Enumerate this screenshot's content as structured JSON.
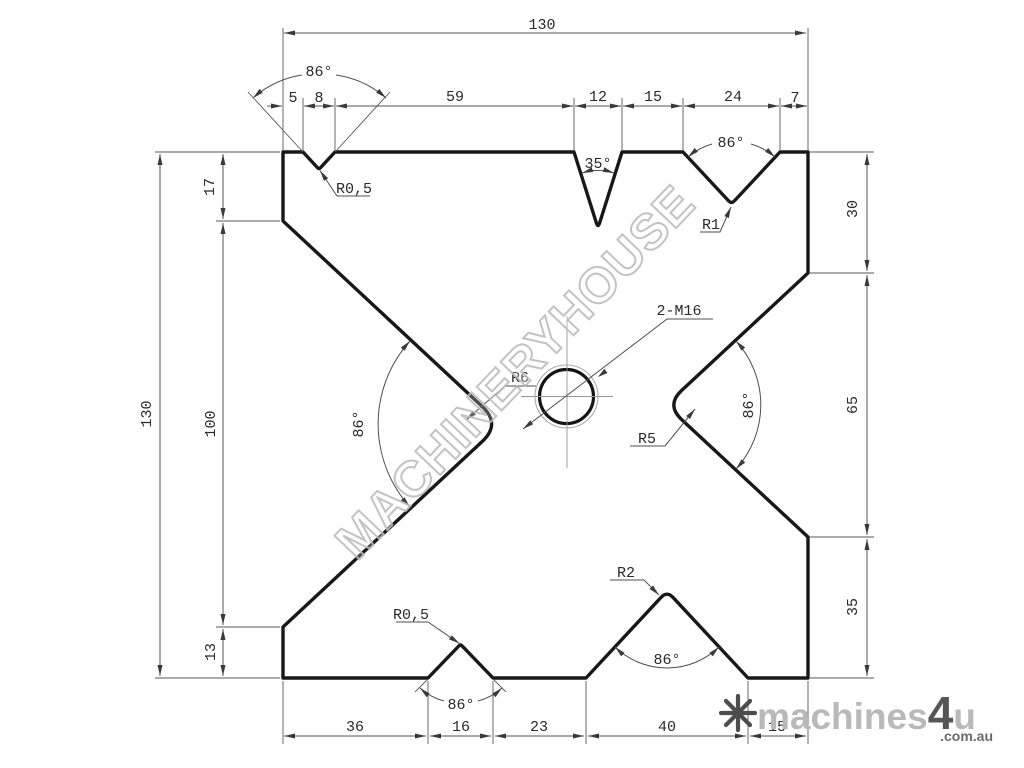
{
  "drawing": {
    "description": "press brake 4-way die block engineering drawing",
    "hole_callout": "2-M16"
  },
  "dimensions": {
    "top_overall": "130",
    "top_row": [
      "5",
      "8",
      "59",
      "12",
      "15",
      "24",
      "7"
    ],
    "left_overall": "130",
    "left_segments": [
      "17",
      "100",
      "13"
    ],
    "right_segments": [
      "30",
      "65",
      "35"
    ],
    "bottom_row": [
      "36",
      "16",
      "23",
      "40",
      "15"
    ]
  },
  "angles": {
    "top_left": "86°",
    "top_center": "35°",
    "top_right": "86°",
    "mid_left": "86°",
    "mid_right": "86°",
    "bottom_left": "86°",
    "bottom_right": "86°"
  },
  "radii": {
    "top_left": "R0,5",
    "top_right": "R1",
    "mid_left": "R6",
    "mid_right": "R5",
    "bottom_left": "R0,5",
    "bottom_right": "R2"
  },
  "watermark": {
    "text": "MACHINERYHOUSE"
  },
  "logo": {
    "brand_light": "machines",
    "brand_accent": "4",
    "brand_suffix": "u",
    "domain": ".com.au"
  },
  "colors": {
    "outline": "#181818",
    "dimension_lines": "#555555",
    "watermark": "#bdbdbd",
    "logo_light": "#b9b9b9",
    "logo_dark": "#565656",
    "logo_domain": "#6b6b6b"
  }
}
